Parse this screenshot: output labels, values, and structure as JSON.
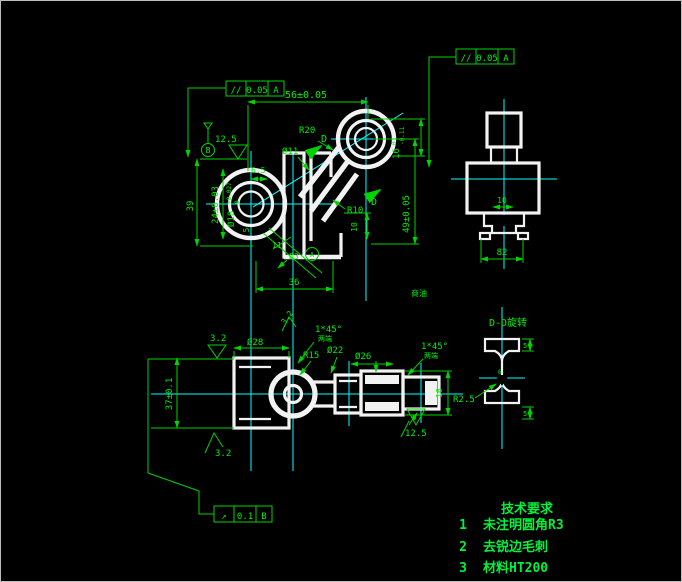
{
  "frames": {
    "tl": {
      "sym": "//",
      "val": "0.05",
      "datum": "A"
    },
    "tr": {
      "sym": "//",
      "val": "0.05",
      "datum": "A"
    },
    "bl": {
      "sym": "↗",
      "val": "0.1",
      "datum": "B"
    }
  },
  "front": {
    "dim56": "56±0.05",
    "dim39": "39",
    "dim24": "24±0.03",
    "bore": "Ø18",
    "bore_up": "+0.027",
    "bore_low": "0",
    "rough": "12.5",
    "datum_b": "B",
    "r20": "R20",
    "d11": "Ø11",
    "c65": "6.5",
    "slot": "16",
    "slot_up": "0",
    "slot_low": "-0.11",
    "dim49": "49±0.05",
    "r10": "R10",
    "dim10": "10",
    "dim5": "5",
    "dim11": "11",
    "oil": "Ø3",
    "datum_a": "A",
    "dim36": "36",
    "sec_d1": "D",
    "sec_d2": "D",
    "note": "商油"
  },
  "side": {
    "dim82": "82",
    "dim10": "10"
  },
  "bottom": {
    "d28": "Ø28",
    "r15": "R15",
    "d22": "Ø22",
    "d26": "Ø26",
    "ch1": "1*45°",
    "ch1_note": "两端",
    "ch2": "1*45°",
    "ch2_note": "两端",
    "rough_a": "3.2",
    "rough_b": "3.2",
    "rough_c": "3.2",
    "dim37": "37±0.1",
    "dim16": "16",
    "rough125": "12.5"
  },
  "section_dd": {
    "title": "D-D旋转",
    "r25": "R2.5",
    "t5a": "5",
    "t5b": "5",
    "web6": "6"
  },
  "tech": {
    "title": "技术要求",
    "items": [
      {
        "no": "1",
        "text": "未注明圆角R3"
      },
      {
        "no": "2",
        "text": "去锐边毛刺"
      },
      {
        "no": "3",
        "text": "材料HT200"
      }
    ]
  }
}
